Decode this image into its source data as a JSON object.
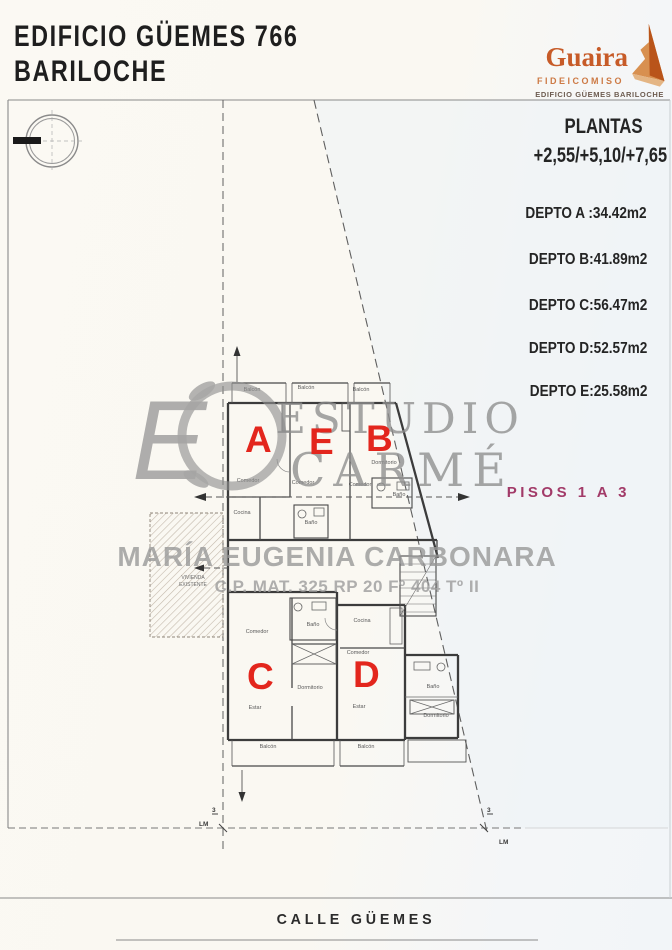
{
  "header": {
    "title_line1": "EDIFICIO GÜEMES 766",
    "title_line2": "BARILOCHE"
  },
  "logo": {
    "name": "Guaira",
    "subtitle": "FIDEICOMISO",
    "tagline": "EDIFICIO GÜEMES BARILOCHE",
    "accent_color": "#c75b28",
    "mountain_icon": "mountain-peak"
  },
  "info_panel": {
    "plantas_title": "PLANTAS",
    "plantas_levels": "+2,55/+5,10/+7,65",
    "deptos": [
      {
        "label": "DEPTO A :34.42m2"
      },
      {
        "label": "DEPTO B:41.89m2"
      },
      {
        "label": "DEPTO C:56.47m2"
      },
      {
        "label": "DEPTO D:52.57m2"
      },
      {
        "label": "DEPTO E:25.58m2"
      }
    ],
    "pisos_label": "PISOS 1 A 3",
    "pisos_color": "#a23a68"
  },
  "watermark": {
    "monogram": "E",
    "studio_line1": "ESTUDIO",
    "studio_line2": "CARMÉ",
    "name": "MARÍA EUGENIA CARBONARA",
    "registration": "C.P. MAT. 325 RP 20 Fº 404 Tº II",
    "color": "#8e8e8e"
  },
  "plan": {
    "letter_color": "#e3261d",
    "unit_letters": [
      {
        "id": "A"
      },
      {
        "id": "E"
      },
      {
        "id": "B"
      },
      {
        "id": "C"
      },
      {
        "id": "D"
      }
    ],
    "room_labels": [
      {
        "text": "Balcón"
      },
      {
        "text": "Balcón"
      },
      {
        "text": "Balcón"
      },
      {
        "text": "Comedor"
      },
      {
        "text": "Comedor"
      },
      {
        "text": "Comedor"
      },
      {
        "text": "Cocina"
      },
      {
        "text": "Baño"
      },
      {
        "text": "Dormitorio"
      },
      {
        "text": "Baño"
      },
      {
        "text": "Comedor"
      },
      {
        "text": "Baño"
      },
      {
        "text": "Cocina"
      },
      {
        "text": "Comedor"
      },
      {
        "text": "Dormitorio"
      },
      {
        "text": "Estar"
      },
      {
        "text": "Estar"
      },
      {
        "text": "Baño"
      },
      {
        "text": "Dormitorio"
      },
      {
        "text": "Balcón"
      },
      {
        "text": "Balcón"
      }
    ],
    "existing_house": {
      "line1": "VIVIENDA",
      "line2": "EXISTENTE"
    },
    "survey_labels": [
      {
        "text": "LM"
      },
      {
        "text": "3"
      },
      {
        "text": "3"
      },
      {
        "text": "LM"
      }
    ]
  },
  "street": {
    "name": "CALLE GÜEMES"
  }
}
